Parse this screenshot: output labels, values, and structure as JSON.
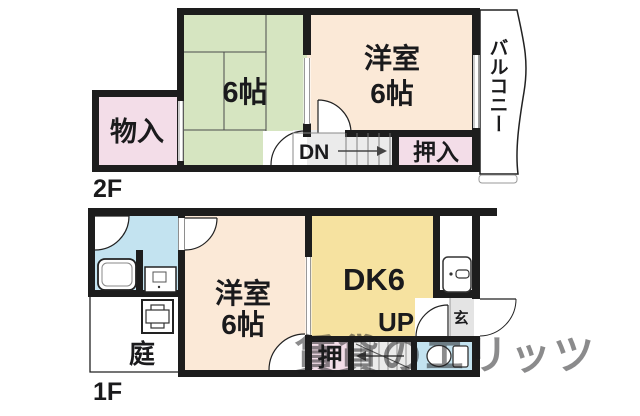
{
  "colors": {
    "tatami_green": "#d6e5c1",
    "room_cream": "#fbe9d7",
    "dk_yellow": "#f6e2a0",
    "closet_pink": "#f3dde8",
    "water_blue": "#c3e3f0",
    "stairs_gray": "#ebebeb",
    "entrance_gray": "#e4e4e4",
    "wall_black": "#1d1d1d",
    "watermark_gray": "#8f93a0"
  },
  "floor2": {
    "label": "2F",
    "tatami_room_label": "6帖",
    "western_room_label_line1": "洋室",
    "western_room_label_line2": "6帖",
    "storage_label": "物入",
    "closet_label": "押入",
    "stairs_label": "DN",
    "balcony_label": "バルコニー"
  },
  "floor1": {
    "label": "1F",
    "western_room_label_line1": "洋室",
    "western_room_label_line2": "6帖",
    "dining_kitchen_label": "DK6",
    "stairs_label": "UP",
    "closet_label": "押",
    "entrance_label": "玄",
    "garden_label": "庭"
  },
  "watermark": "賃貸のエリッツ"
}
